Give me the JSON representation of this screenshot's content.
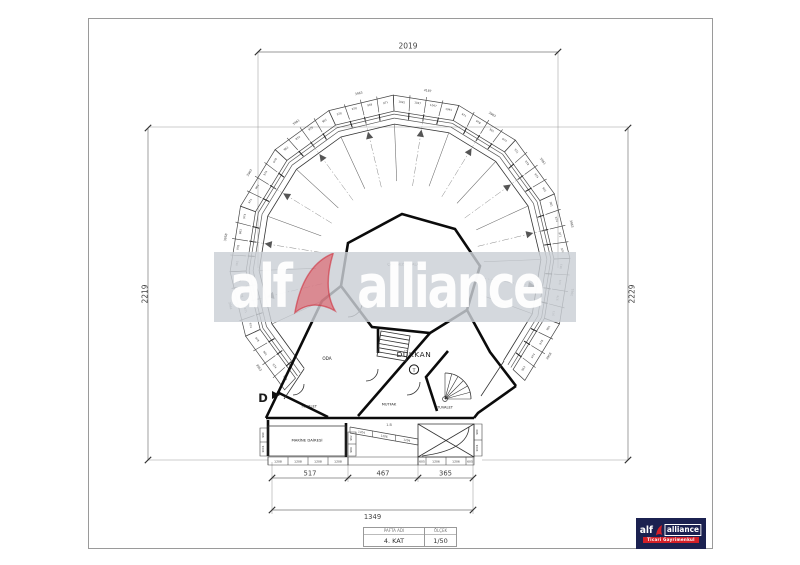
{
  "watermark": {
    "word1": "alf",
    "word2": "alliance"
  },
  "logo": {
    "word1": "alf",
    "word2": "alliance",
    "tagline": "Ticari Gayrimenkul"
  },
  "title_block": {
    "sheet_header": "PAFTA ADI",
    "sheet_value": "4. KAT",
    "scale_header": "ÖLÇEK",
    "scale_value": "1/50"
  },
  "dimensions": {
    "top": "2019",
    "left": "2219",
    "right": "2229",
    "bottom_segments": [
      "517",
      "467",
      "365"
    ],
    "bottom_total": "1349"
  },
  "plan": {
    "roof_label": "ÇATI GEZİNTİ ALANI",
    "rooms": {
      "oda": "ODA",
      "dukkan": "DÜKKAN",
      "dukkan_tag": "T",
      "mutfak": "MUTFAK",
      "tuvalet_left": "TUVALET",
      "tuvalet_right": "TUVALET",
      "makine": "MAKİNE DAİRESİ"
    },
    "section_marker": "D",
    "beam_label": "1.B",
    "ring_edges": [
      {
        "total": "3958",
        "cells": [
          "963",
          "974",
          "978",
          "961"
        ]
      },
      {
        "total": "3961",
        "cells": [
          "971",
          "978",
          "974",
          "963"
        ]
      },
      {
        "total": "3963",
        "cells": [
          "978",
          "971",
          "974",
          "961"
        ]
      },
      {
        "total": "3961",
        "cells": [
          "961",
          "974",
          "978",
          "971"
        ]
      },
      {
        "total": "3963",
        "cells": [
          "974",
          "961",
          "978",
          "971"
        ]
      },
      {
        "total": "4187",
        "cells": [
          "1045",
          "1047",
          "1047",
          "1045"
        ]
      },
      {
        "total": "3963",
        "cells": [
          "971",
          "949",
          "978",
          "978"
        ]
      },
      {
        "total": "3961",
        "cells": [
          "961",
          "978",
          "974",
          "963"
        ]
      },
      {
        "total": "3963",
        "cells": [
          "978",
          "974",
          "961",
          "971"
        ]
      },
      {
        "total": "3958",
        "cells": [
          "974",
          "963",
          "978",
          "961"
        ]
      },
      {
        "total": "3961",
        "cells": [
          "963",
          "978",
          "971",
          "974"
        ]
      },
      {
        "total": "3963",
        "cells": [
          "978",
          "961",
          "974",
          "963"
        ]
      }
    ],
    "bottom_left_cells": [
      "1208",
      "1208",
      "1208",
      "1208"
    ],
    "bottom_right_cells": [
      "605",
      "1206",
      "1206",
      "605"
    ],
    "slope_cells": [
      "1204",
      "1206",
      "1204"
    ],
    "left_col_cells": [
      "990",
      "1001"
    ],
    "mid_col_cells": [
      "962",
      "984"
    ],
    "right_col_cells": [
      "980",
      "1001"
    ]
  }
}
